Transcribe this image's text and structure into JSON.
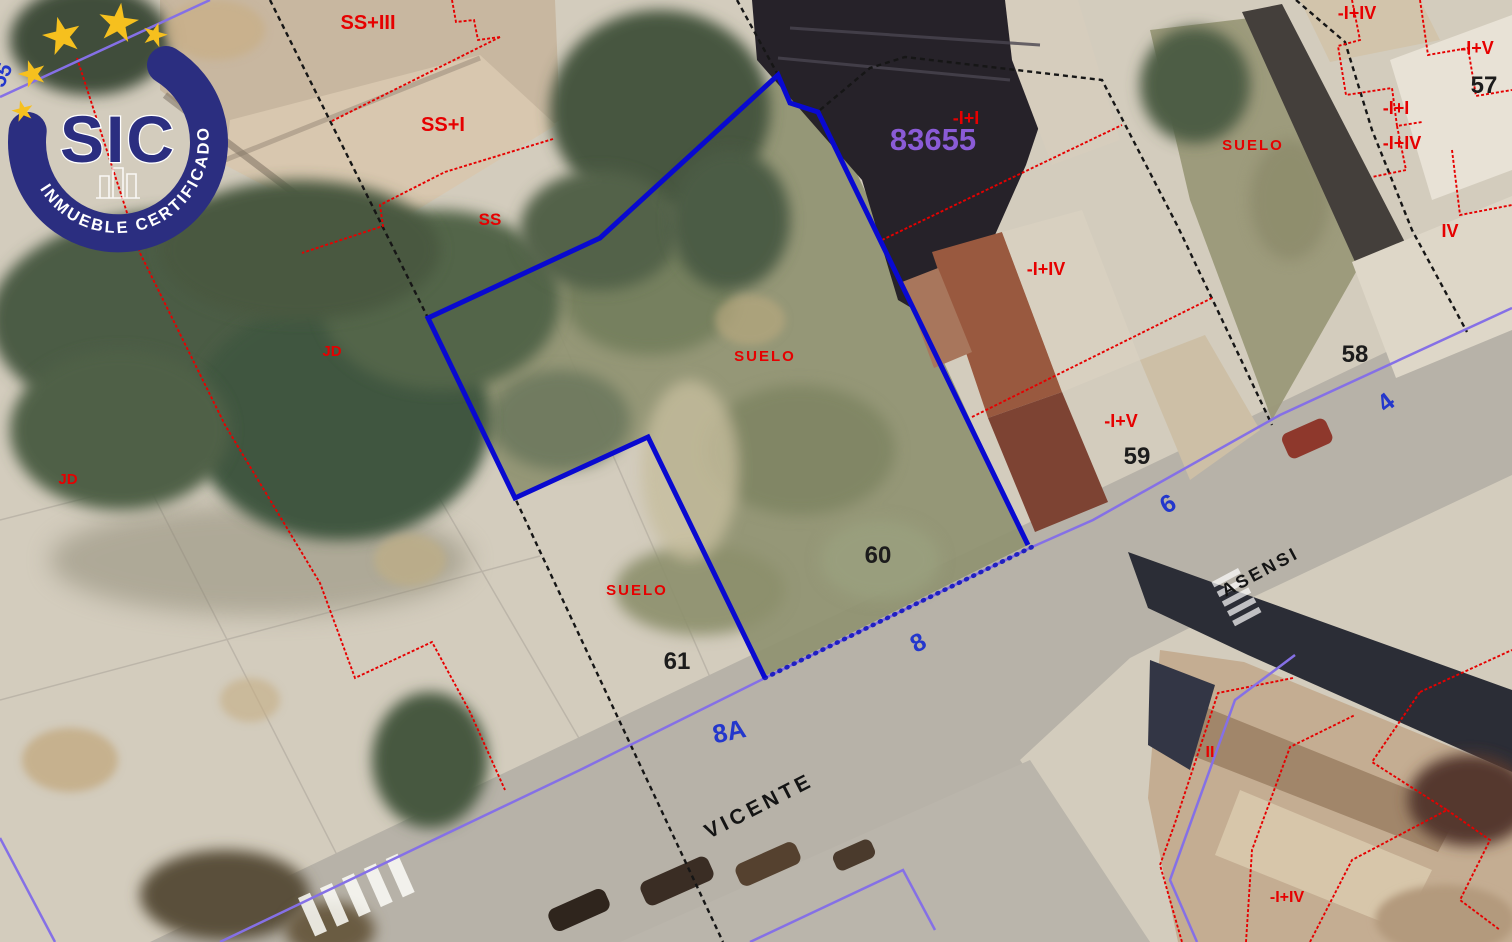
{
  "watermark": {
    "abbr": "SIC",
    "tagline": "INMUEBLE CERTIFICADO",
    "star_count": 5,
    "colors": {
      "arc_navy": "#2b2e80",
      "star_gold": "#f6c01e",
      "tagline_white": "#ffffff"
    }
  },
  "map": {
    "parcel_ref": "83655",
    "parcel_numbers": [
      "57",
      "58",
      "59",
      "60",
      "61"
    ],
    "red_labels": [
      "SS+III",
      "SS+I",
      "SS",
      "SUELO",
      "SUELO",
      "SUELO",
      "JD",
      "JD",
      "-I+I",
      "-I+IV",
      "-I+V",
      "-I+IV",
      "-I+V",
      "-I+I",
      "-I+IV",
      "IV",
      "II",
      "-I+IV"
    ],
    "street_names": [
      "VICENTE",
      "ASENSI"
    ],
    "street_numbers": [
      "55",
      "8A",
      "8",
      "6",
      "4"
    ],
    "colors": {
      "cadastral_red": "#e60000",
      "boundary_black": "#161616",
      "selected_parcel_blue": "#0909d0",
      "street_axis_violet": "#8570e6",
      "parcel_ref_purple": "#8a5bd6",
      "street_number_blue": "#2337cc"
    }
  }
}
